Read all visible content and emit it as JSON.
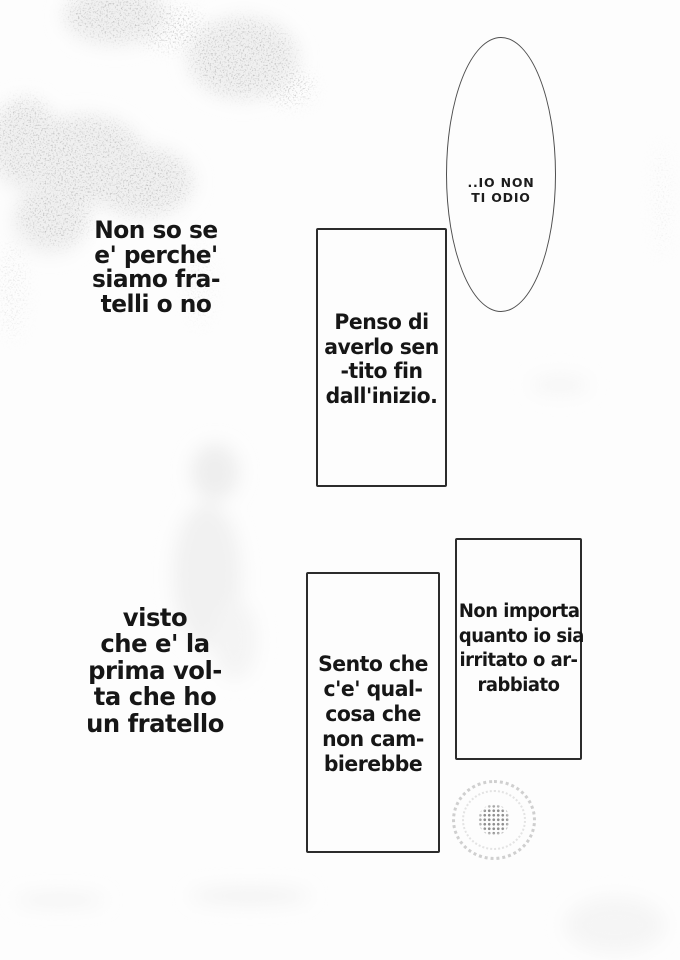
{
  "page": {
    "kind": "manga page scan (Italian translation)",
    "paper_color": "#fdfdfd",
    "ink_color": "#1a1a1a",
    "box_border_color": "#2c2c2c"
  },
  "speech": {
    "ellipse_bubble": {
      "lines": [
        "..IO NON",
        "TI ODIO"
      ]
    },
    "narration_top_left": {
      "lines": [
        "Non so se",
        "e' perche'",
        "siamo fra-",
        "telli o no"
      ]
    },
    "box_penso": {
      "lines": [
        "Penso di",
        "averlo sen",
        "-tito fin",
        "dall'inizio."
      ]
    },
    "narration_bottom_left": {
      "lines": [
        "visto",
        "che e' la",
        "prima vol-",
        "ta che ho",
        "un fratello"
      ]
    },
    "box_sento": {
      "lines": [
        "Sento che",
        "c'e' qual-",
        "cosa che",
        "non cam-",
        "bierebbe"
      ]
    },
    "box_non_importa": {
      "lines": [
        "Non importa",
        "quanto io sia",
        "irritato o ar-",
        "rabbiato"
      ]
    }
  },
  "decorations": {
    "screentone": "grainy gray noise clouds, top-left quadrant",
    "flower_motif": "faint stippled dot ring with dense dotted core, bottom right"
  }
}
